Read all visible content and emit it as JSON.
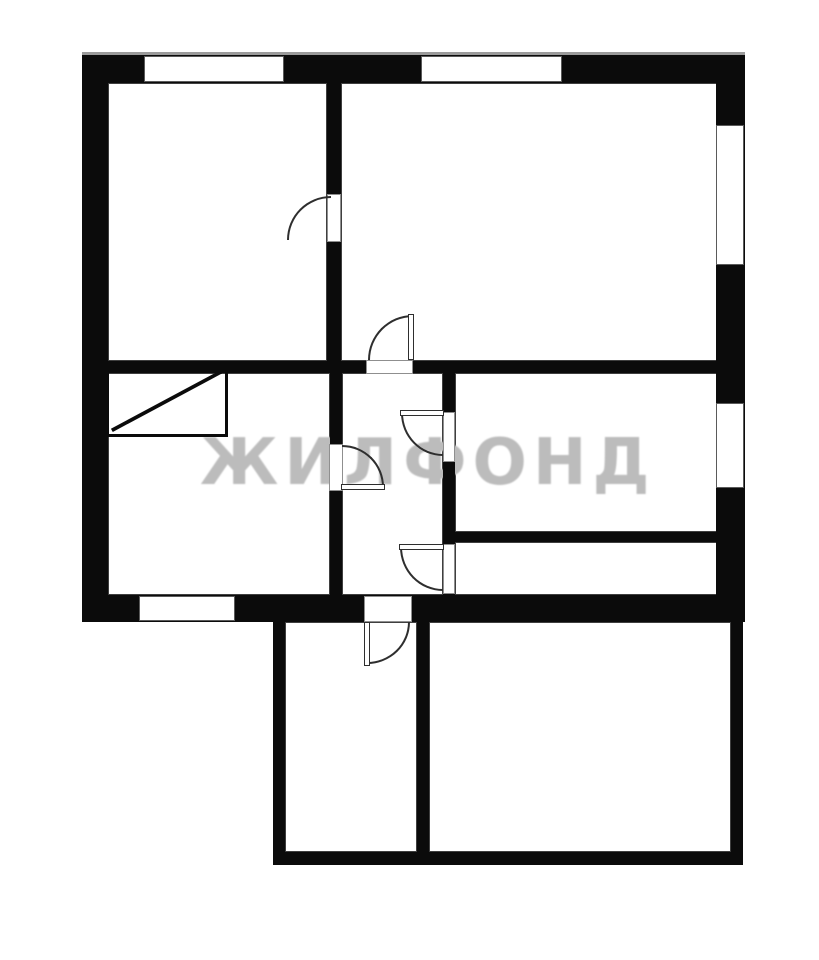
{
  "watermark": {
    "text": "ЖИЛФОНД",
    "color": "#bcbcbc",
    "x": 200,
    "y": 431,
    "font_size": 64,
    "letter_spacing": 6
  },
  "plan": {
    "canvas": {
      "width": 819,
      "height": 960,
      "background": "#ffffff"
    },
    "wall_color": "#0b0b0b",
    "line_color": "#2e2e2e",
    "rooms": [
      {
        "name": "room-top-left",
        "x": 108,
        "y": 83,
        "w": 219,
        "h": 278
      },
      {
        "name": "room-top-right",
        "x": 341,
        "y": 83,
        "w": 377,
        "h": 278
      },
      {
        "name": "room-mid-left",
        "x": 108,
        "y": 373,
        "w": 222,
        "h": 222
      },
      {
        "name": "room-hallway",
        "x": 342,
        "y": 373,
        "w": 101,
        "h": 222
      },
      {
        "name": "room-mid-right",
        "x": 455,
        "y": 373,
        "w": 263,
        "h": 159
      },
      {
        "name": "room-narrow-right",
        "x": 455,
        "y": 542,
        "w": 263,
        "h": 53
      },
      {
        "name": "room-ext-left",
        "x": 285,
        "y": 622,
        "w": 132,
        "h": 230
      },
      {
        "name": "room-ext-right",
        "x": 429,
        "y": 622,
        "w": 302,
        "h": 230
      }
    ],
    "closet": {
      "name": "closet-with-diagonal",
      "x": 106,
      "y": 367,
      "w": 122,
      "h": 70
    },
    "top_edge_line": {
      "name": "outer-top-edge-line",
      "x": 82,
      "y": 52,
      "w": 663,
      "h": 3
    },
    "walls": [
      {
        "name": "wall-outer-top",
        "x": 82,
        "y": 55,
        "w": 663,
        "h": 28
      },
      {
        "name": "wall-outer-left",
        "x": 82,
        "y": 55,
        "w": 26,
        "h": 567
      },
      {
        "name": "wall-outer-right",
        "x": 716,
        "y": 55,
        "w": 29,
        "h": 567
      },
      {
        "name": "wall-outer-bottom",
        "x": 82,
        "y": 595,
        "w": 663,
        "h": 27
      },
      {
        "name": "wall-top-divider",
        "x": 327,
        "y": 83,
        "w": 14,
        "h": 290
      },
      {
        "name": "wall-mid-horizontal",
        "x": 108,
        "y": 361,
        "w": 610,
        "h": 12
      },
      {
        "name": "wall-hall-left",
        "x": 330,
        "y": 373,
        "w": 12,
        "h": 222
      },
      {
        "name": "wall-hall-right",
        "x": 443,
        "y": 373,
        "w": 12,
        "h": 222
      },
      {
        "name": "wall-mid-right-divider",
        "x": 443,
        "y": 532,
        "w": 275,
        "h": 10
      },
      {
        "name": "wall-ext-left",
        "x": 273,
        "y": 622,
        "w": 12,
        "h": 243
      },
      {
        "name": "wall-ext-right",
        "x": 731,
        "y": 622,
        "w": 12,
        "h": 243
      },
      {
        "name": "wall-ext-bottom",
        "x": 273,
        "y": 852,
        "w": 470,
        "h": 13
      },
      {
        "name": "wall-ext-divider",
        "x": 417,
        "y": 622,
        "w": 12,
        "h": 233
      }
    ],
    "windows": [
      {
        "name": "window-top-left",
        "x": 144,
        "y": 56,
        "w": 140,
        "h": 26
      },
      {
        "name": "window-top-right",
        "x": 421,
        "y": 56,
        "w": 141,
        "h": 26
      },
      {
        "name": "window-right-upper",
        "x": 716,
        "y": 125,
        "w": 28,
        "h": 140
      },
      {
        "name": "window-right-lower",
        "x": 716,
        "y": 403,
        "w": 28,
        "h": 85
      },
      {
        "name": "window-bottom-left",
        "x": 139,
        "y": 596,
        "w": 96,
        "h": 25
      }
    ],
    "door_openings": [
      {
        "name": "door-opening-top-rooms",
        "x": 327,
        "y": 194,
        "w": 14,
        "h": 48
      },
      {
        "name": "door-opening-hall-top",
        "x": 366,
        "y": 360,
        "w": 47,
        "h": 14
      },
      {
        "name": "door-opening-hall-left",
        "x": 329,
        "y": 444,
        "w": 14,
        "h": 47
      },
      {
        "name": "door-opening-hall-right-up",
        "x": 443,
        "y": 412,
        "w": 12,
        "h": 50
      },
      {
        "name": "door-opening-hall-right-dn",
        "x": 443,
        "y": 544,
        "w": 12,
        "h": 50
      },
      {
        "name": "door-opening-hall-bottom",
        "x": 364,
        "y": 596,
        "w": 48,
        "h": 26
      }
    ],
    "door_arcs": [
      {
        "name": "door-swing-top-rooms",
        "x": 287,
        "y": 196,
        "w": 44,
        "h": 44,
        "corner": "tl"
      },
      {
        "name": "door-swing-hall-top",
        "x": 368,
        "y": 315,
        "w": 45,
        "h": 45,
        "corner": "tl"
      },
      {
        "name": "door-swing-hall-left",
        "x": 342,
        "y": 445,
        "w": 42,
        "h": 42,
        "corner": "tr"
      },
      {
        "name": "door-swing-hall-right-up",
        "x": 401,
        "y": 413,
        "w": 42,
        "h": 43,
        "corner": "bl"
      },
      {
        "name": "door-swing-hall-right-dn",
        "x": 400,
        "y": 547,
        "w": 43,
        "h": 44,
        "corner": "bl"
      },
      {
        "name": "door-swing-hall-bottom",
        "x": 367,
        "y": 622,
        "w": 43,
        "h": 42,
        "corner": "br"
      }
    ],
    "door_leaves": [
      {
        "name": "door-leaf-hall-top",
        "x": 408,
        "y": 314,
        "w": 6,
        "h": 46
      },
      {
        "name": "door-leaf-hall-left",
        "x": 341,
        "y": 484,
        "w": 44,
        "h": 6
      },
      {
        "name": "door-leaf-hall-right-up",
        "x": 400,
        "y": 410,
        "w": 44,
        "h": 6
      },
      {
        "name": "door-leaf-hall-right-dn",
        "x": 399,
        "y": 544,
        "w": 45,
        "h": 6
      },
      {
        "name": "door-leaf-hall-bottom",
        "x": 364,
        "y": 622,
        "w": 6,
        "h": 44
      }
    ]
  }
}
